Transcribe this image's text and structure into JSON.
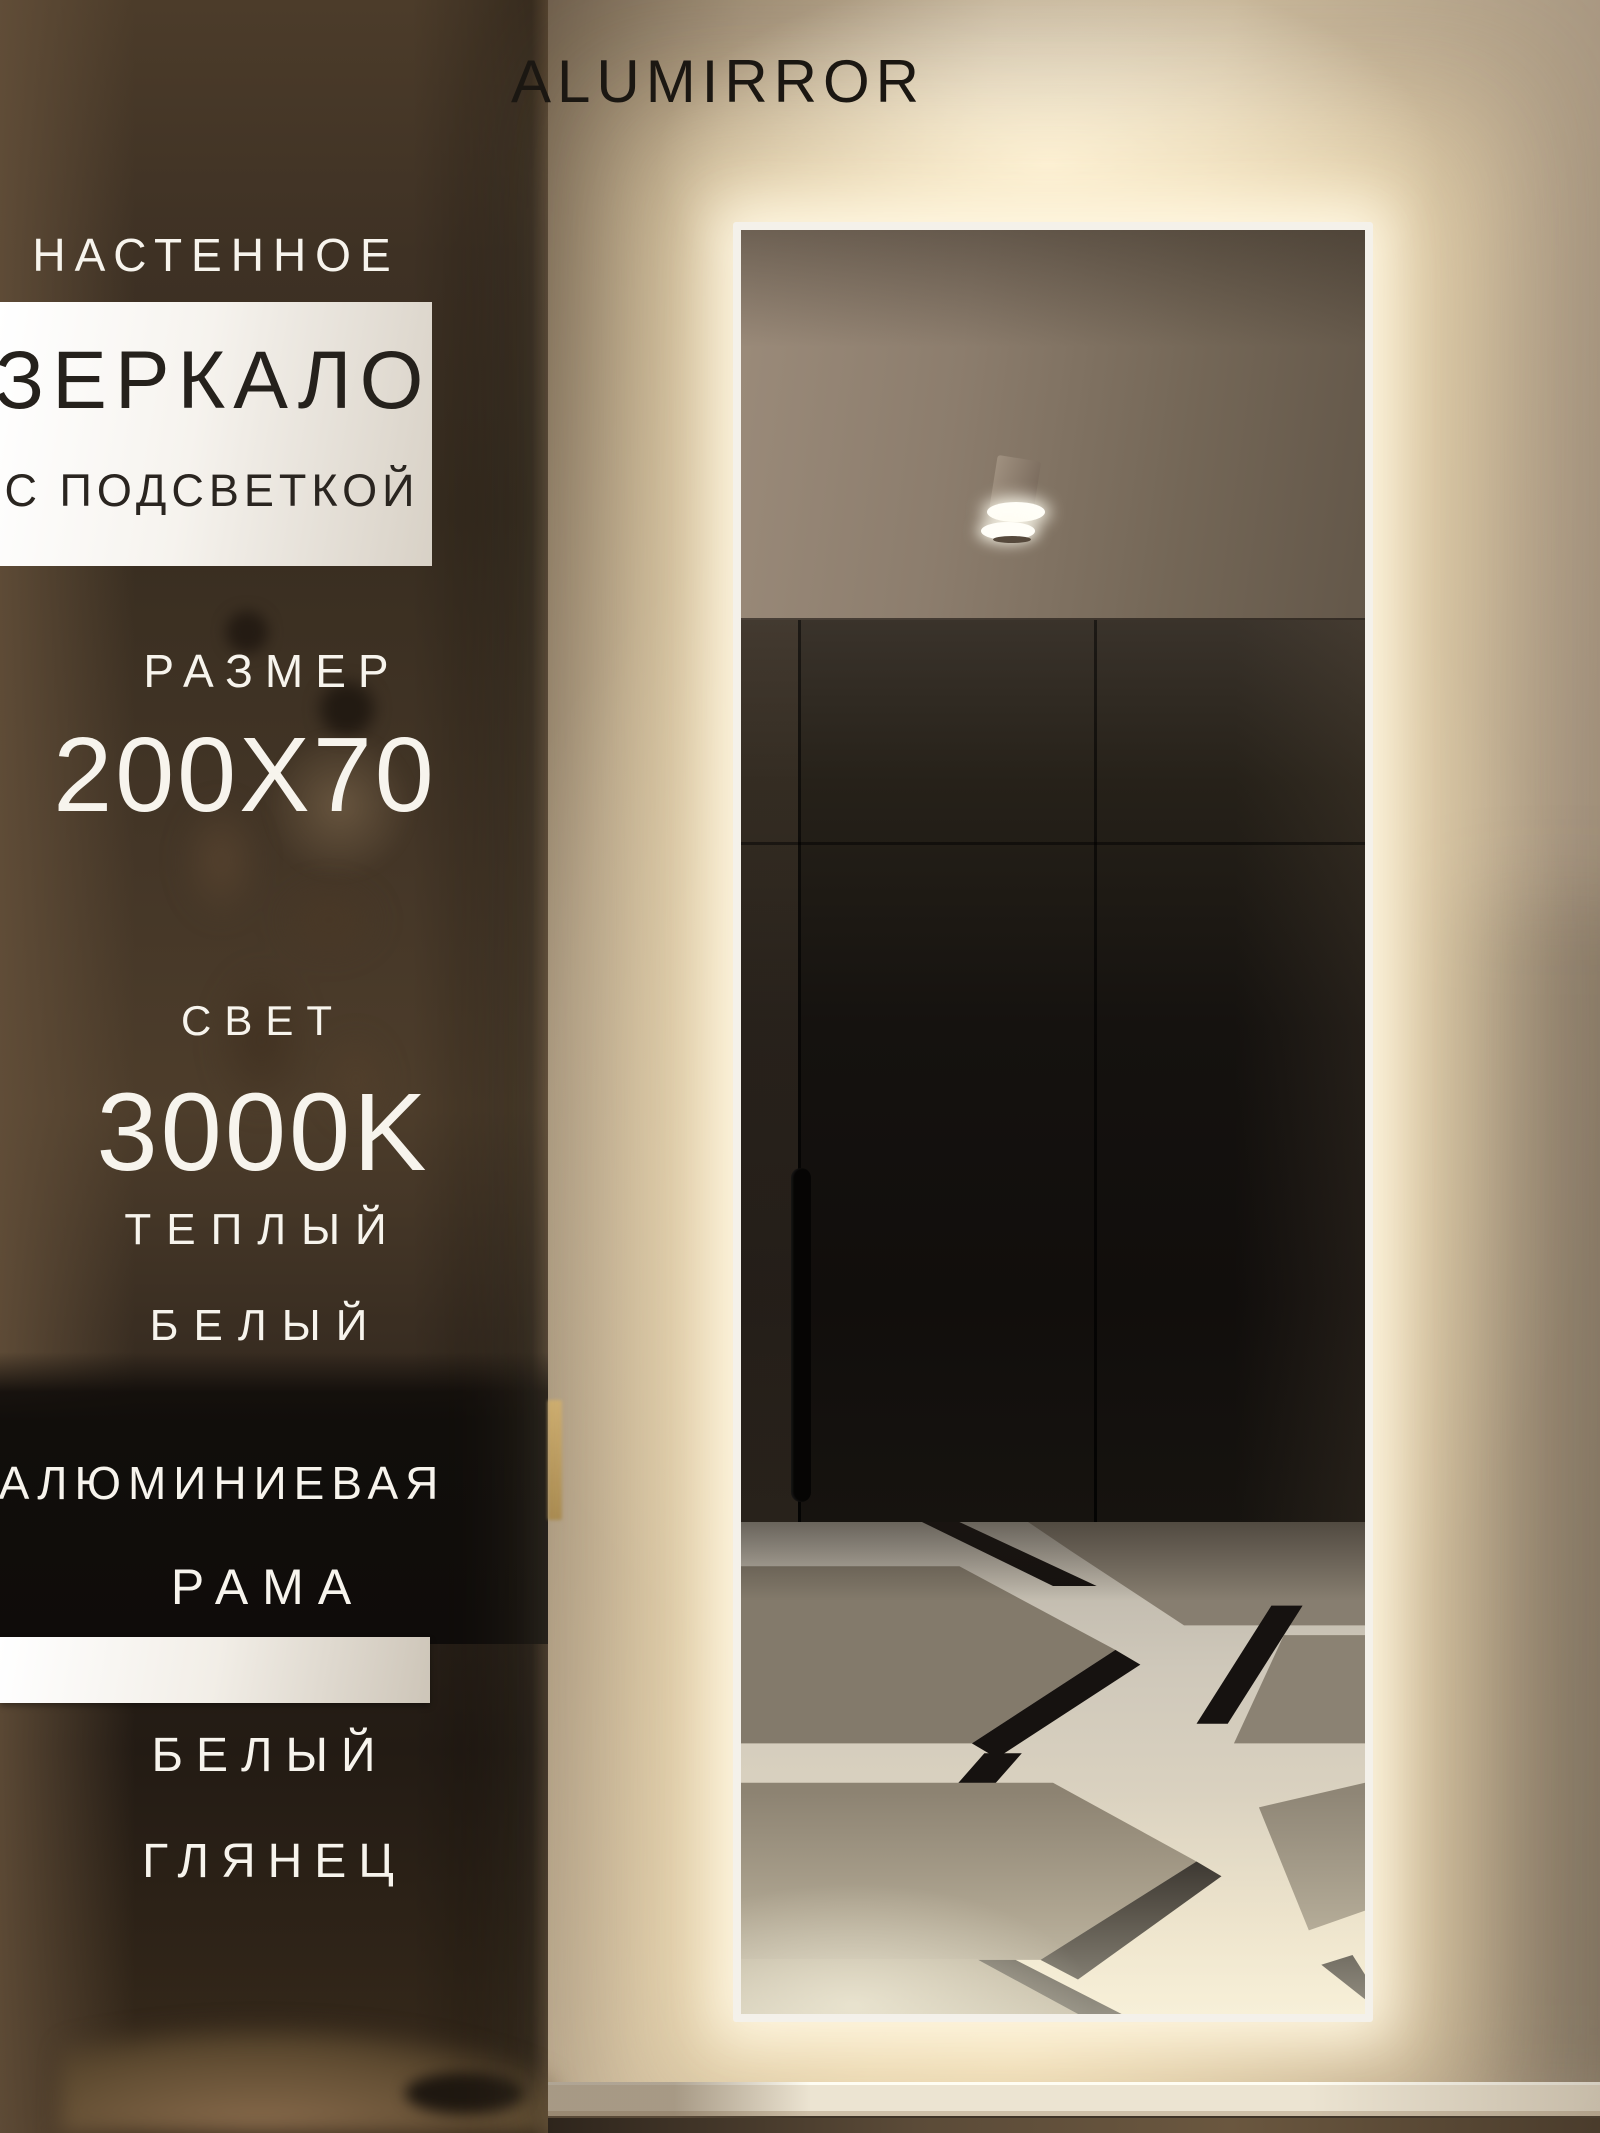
{
  "brand": {
    "title": "ALUMIRROR"
  },
  "overlay": {
    "wall_mounted": "НАСТЕННОЕ",
    "product": "ЗЕРКАЛО",
    "with_backlight": "С ПОДСВЕТКОЙ",
    "size_label": "РАЗМЕР",
    "size_value": "200X70",
    "light_label": "СВЕТ",
    "light_value": "3000K",
    "light_warm": "ТЕПЛЫЙ",
    "light_white": "БЕЛЫЙ",
    "frame_material": "АЛЮМИНИЕВАЯ",
    "frame_word": "РАМА",
    "finish_color": "БЕЛЫЙ",
    "finish_gloss": "ГЛЯНЕЦ"
  },
  "colors": {
    "glow_warm": "#ffe9c0",
    "frame_white": "#f4f1ea",
    "wall_beige": "#bfae94",
    "hall_brown": "#3e3124",
    "wardrobe_black": "#15120f",
    "tile_white": "#e0d7c3",
    "tile_grey": "#8a8172",
    "tile_black": "#161210",
    "text_dark": "#25211c",
    "text_white": "#f7f4ed"
  }
}
